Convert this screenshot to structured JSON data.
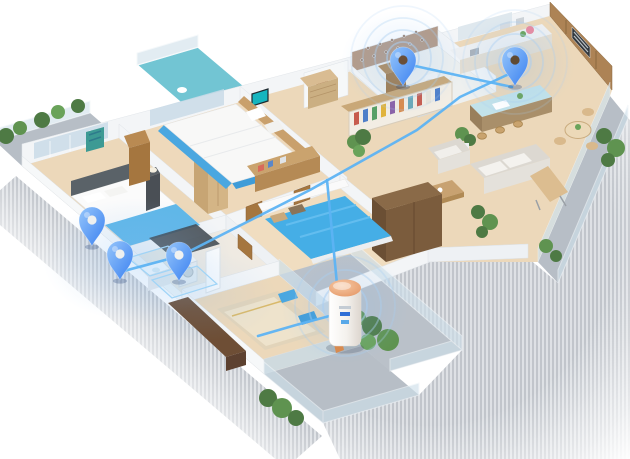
{
  "scene": {
    "label": "3D isometric apartment floor plan with smart-home coverage pins, signal waves, connection lines and a hub device",
    "background": "#ffffff"
  },
  "colors": {
    "pin_light": "#96c6fb",
    "pin_dark": "#3a80f0",
    "line": "#5db3f3",
    "ring": "#a9cef2",
    "glow": "#82b9f2",
    "device_body": "#f6f4f1",
    "device_top": "#eda87e",
    "device_accent": "#2f6fd6",
    "teal_floor": "#72c5d3",
    "bed_blue": "#45aee6",
    "wood_floor": "#ecd8ba",
    "balcony_gray": "#b7bec6",
    "shadow_stripe_dark": "#858d99",
    "shadow_stripe_light": "#bfc5cd"
  },
  "rooms": [
    {
      "name": "master-bedroom",
      "contents": "double bed with blue throw, dark rug, wardrobe, wall art, balcony"
    },
    {
      "name": "bedroom-2",
      "contents": "double bed, brown wardrobe, teal TV, dresser, teal terrace"
    },
    {
      "name": "bathroom",
      "contents": "patterned wall, cabinet, bathtub, toilet, vanity"
    },
    {
      "name": "kitchen",
      "contents": "island with pale blue top, counter, tall cabinets, double oven, round dining table"
    },
    {
      "name": "living-dining",
      "contents": "sofa, armchair, coffee table, bookshelf, large cabinet, plants"
    },
    {
      "name": "middle-bedroom",
      "contents": "double bed with bright blue duvet"
    },
    {
      "name": "laundry-corridor",
      "contents": "washbasin, washing machine, tall mirror cabinet"
    },
    {
      "name": "tatami-room",
      "contents": "low beige bed, blue floor cushions, dark wardrobe"
    },
    {
      "name": "balconies",
      "contents": "potted plants, tan lounge chair, glass railings"
    }
  ],
  "overlay": {
    "glows": [
      {
        "name": "corridor-glow",
        "cx": 138,
        "cy": 260,
        "rx": 95,
        "ry": 62,
        "opacity": 0.55
      },
      {
        "name": "bathroom-glow",
        "cx": 403,
        "cy": 62,
        "rx": 62,
        "ry": 52,
        "opacity": 0.45
      },
      {
        "name": "kitchen-glow",
        "cx": 515,
        "cy": 66,
        "rx": 60,
        "ry": 50,
        "opacity": 0.45
      },
      {
        "name": "device-glow",
        "cx": 345,
        "cy": 308,
        "rx": 64,
        "ry": 56,
        "opacity": 0.5
      },
      {
        "name": "tatami-glow",
        "cx": 200,
        "cy": 296,
        "rx": 78,
        "ry": 46,
        "opacity": 0.3
      }
    ],
    "ring_sets": [
      {
        "name": "bathroom-signal",
        "cx": 403,
        "cy": 58,
        "radii": [
          16,
          28,
          40,
          52
        ]
      },
      {
        "name": "kitchen-signal",
        "cx": 515,
        "cy": 62,
        "radii": [
          16,
          28,
          40,
          52
        ]
      },
      {
        "name": "device-signal",
        "cx": 345,
        "cy": 306,
        "radii": [
          22,
          36,
          50
        ]
      }
    ],
    "connections": {
      "width": 2.6,
      "lines": [
        {
          "name": "kitchen-to-corridor",
          "points": [
            [
              509,
              74
            ],
            [
              460,
              97
            ],
            [
              417,
              130
            ],
            [
              310,
              190
            ],
            [
              180,
              256
            ],
            [
              120,
              272
            ]
          ]
        },
        {
          "name": "bathroom-to-kitchen",
          "points": [
            [
              406,
              64
            ],
            [
              470,
              78
            ],
            [
              512,
              87
            ]
          ]
        },
        {
          "name": "branch-to-device",
          "points": [
            [
              327,
              180
            ],
            [
              341,
              326
            ]
          ]
        },
        {
          "name": "device-to-room",
          "points": [
            [
              337,
              314
            ],
            [
              296,
              325
            ],
            [
              258,
              336
            ]
          ]
        }
      ]
    },
    "floor_highlights": [
      {
        "name": "corridor-zone-1",
        "points": [
          [
            128,
            258
          ],
          [
            168,
            246
          ],
          [
            190,
            264
          ],
          [
            150,
            276
          ]
        ]
      },
      {
        "name": "corridor-zone-2",
        "points": [
          [
            152,
            280
          ],
          [
            197,
            266
          ],
          [
            217,
            284
          ],
          [
            172,
            298
          ]
        ]
      }
    ],
    "pins": [
      {
        "id": "pin-bedroom-corner",
        "label": "master-bedroom corner",
        "x": 92,
        "y": 246,
        "hole": "#eef0ef"
      },
      {
        "id": "pin-laundry",
        "label": "laundry corridor",
        "x": 120,
        "y": 280,
        "hole": "#eef0ef"
      },
      {
        "id": "pin-hallway",
        "label": "hallway",
        "x": 179,
        "y": 281,
        "hole": "#f1f2f0"
      },
      {
        "id": "pin-bathroom",
        "label": "bathroom",
        "x": 403,
        "y": 86,
        "hole": "#6a4f38"
      },
      {
        "id": "pin-kitchen",
        "label": "kitchen",
        "x": 515,
        "y": 86,
        "hole": "#5f4a33"
      }
    ],
    "device": {
      "id": "smart-hub",
      "label": "smart home hub on balcony",
      "x": 345,
      "y": 346
    }
  }
}
